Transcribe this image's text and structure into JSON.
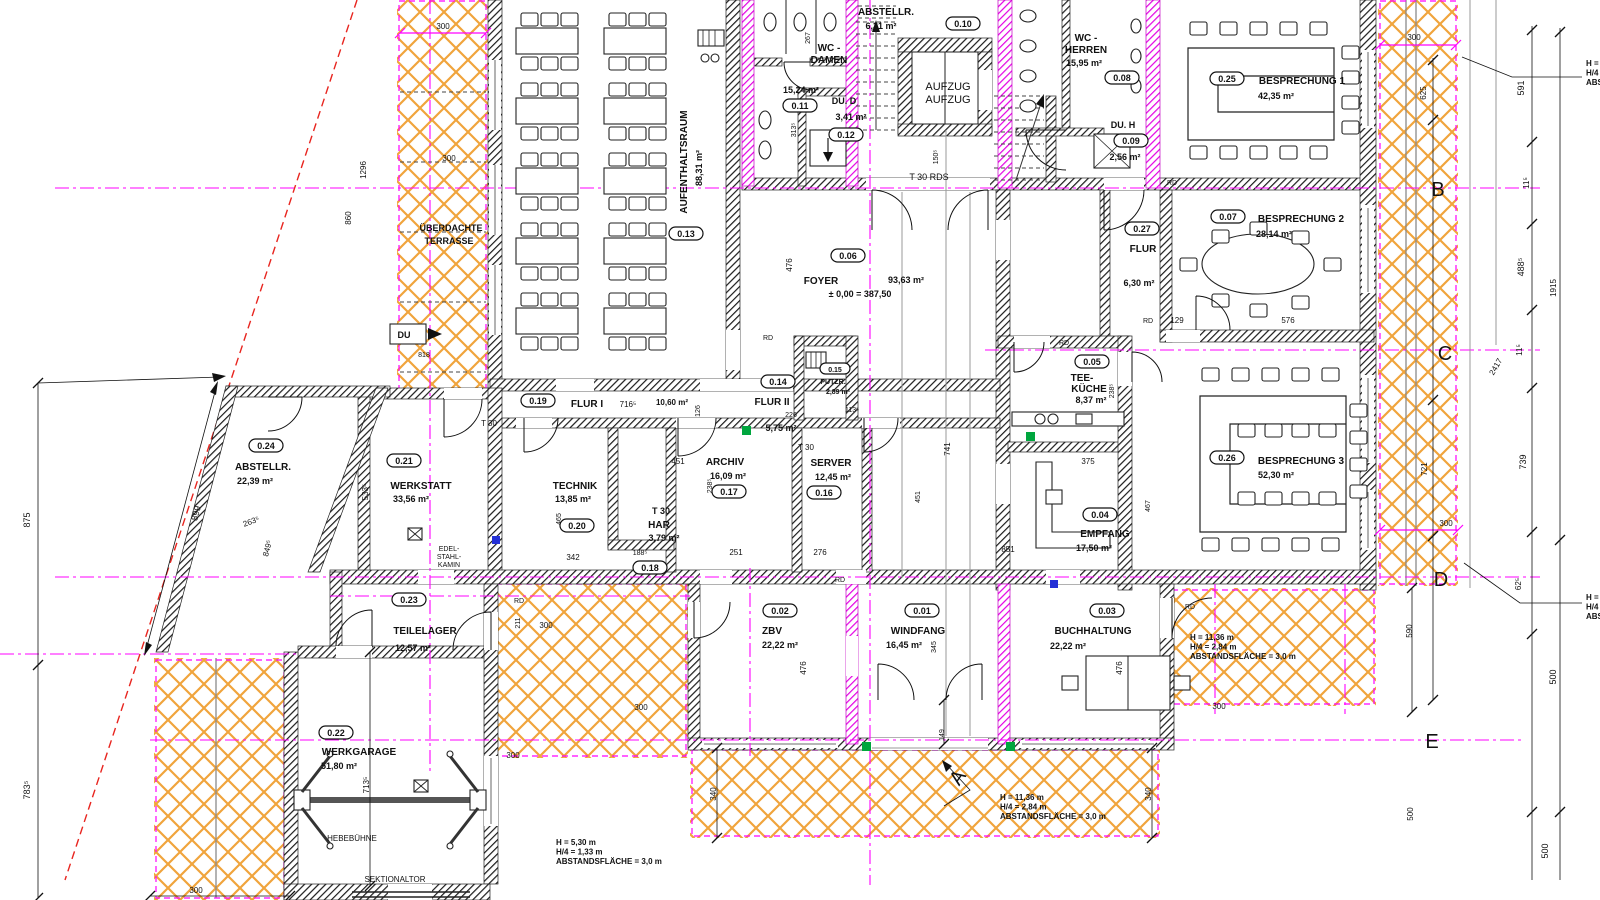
{
  "colors": {
    "hatch_orange": "#f0a43c",
    "axis_magenta": "#ff00ff",
    "boundary_red": "#e8251f",
    "wall_black": "#141414",
    "marker_green": "#00a63e",
    "marker_blue": "#2430d6"
  },
  "terrace": {
    "line1": "ÜBERDACHTE",
    "line2": "TERRASSE"
  },
  "rooms": [
    {
      "id": "0.01",
      "name": "WINDFANG",
      "area": "16,45 m²"
    },
    {
      "id": "0.02",
      "name": "ZBV",
      "area": "22,22 m²"
    },
    {
      "id": "0.03",
      "name": "BUCHHALTUNG",
      "area": "22,22 m²"
    },
    {
      "id": "0.04",
      "name": "EMPFANG",
      "area": "17,50 m²"
    },
    {
      "id": "0.05",
      "name": "TEE-",
      "name2": "KÜCHE",
      "area": "8,37 m²"
    },
    {
      "id": "0.06",
      "name": "FOYER",
      "area": "93,63 m²",
      "level": "± 0,00 = 387,50"
    },
    {
      "id": "0.07",
      "name": "BESPRECHUNG 2",
      "area": "28,14 m²"
    },
    {
      "id": "0.08",
      "name": "WC -",
      "name2": "HERREN",
      "area": "15,95 m²"
    },
    {
      "id": "0.09",
      "name": "DU. H",
      "area": "2,56 m²"
    },
    {
      "id": "0.10",
      "name": "ABSTELLR.",
      "area": "6,31 m²"
    },
    {
      "id": "0.11",
      "name": "WC -",
      "name2": "DAMEN",
      "area": "15,24 m²"
    },
    {
      "id": "0.12",
      "name": "DU. D",
      "area": "3,41 m²"
    },
    {
      "id": "0.13",
      "name": "AUFENTHALTSRAUM",
      "area": "88,31 m²"
    },
    {
      "id": "0.14",
      "name": "FLUR II",
      "area": "5,75 m²"
    },
    {
      "id": "0.15",
      "name": "PUTZR.",
      "area": "2,89 m²"
    },
    {
      "id": "0.16",
      "name": "SERVER",
      "area": "12,45 m²"
    },
    {
      "id": "0.17",
      "name": "ARCHIV",
      "area": "16,09 m²"
    },
    {
      "id": "0.18",
      "name": "HAR",
      "pre": "T 30",
      "area": "3,79 m²"
    },
    {
      "id": "0.19",
      "name": "FLUR I",
      "area": "10,60 m²"
    },
    {
      "id": "0.20",
      "name": "TECHNIK",
      "area": "13,85 m²"
    },
    {
      "id": "0.21",
      "name": "WERKSTATT",
      "area": "33,56 m²"
    },
    {
      "id": "0.22",
      "name": "WERKGARAGE",
      "area": "51,80 m²"
    },
    {
      "id": "0.23",
      "name": "TEILELAGER",
      "area": "12,57 m²"
    },
    {
      "id": "0.24",
      "name": "ABSTELLR.",
      "area": "22,39 m²"
    },
    {
      "id": "0.25",
      "name": "BESPRECHUNG 1",
      "area": "42,35 m²"
    },
    {
      "id": "0.26",
      "name": "BESPRECHUNG 3",
      "area": "52,30 m²"
    },
    {
      "id": "0.27",
      "name": "FLUR",
      "area": "6,30 m²"
    }
  ],
  "notes": [
    {
      "lines": [
        "H = 5,30 m",
        "H/4 = 1,33 m",
        "ABSTANDSFLÄCHE = 3,0 m"
      ],
      "x": 556,
      "y": 845
    },
    {
      "lines": [
        "H = 11,36 m",
        "H/4 = 2,84 m",
        "ABSTANDSFLÄCHE = 3,0 m"
      ],
      "x": 1000,
      "y": 800
    },
    {
      "lines": [
        "H = 11,36 m",
        "H/4 = 2,84 m",
        "ABSTANDSFLÄCHE = 3,0 m"
      ],
      "x": 1190,
      "y": 640
    },
    {
      "lines": [
        "H =",
        "H/4",
        "ABS"
      ],
      "x": 1586,
      "y": 66
    },
    {
      "lines": [
        "H =",
        "H/4",
        "ABS"
      ],
      "x": 1586,
      "y": 600
    }
  ],
  "grid_letters": [
    {
      "t": "A",
      "x": 963,
      "y": 781,
      "r": -55
    },
    {
      "t": "B",
      "x": 1438,
      "y": 196
    },
    {
      "t": "C",
      "x": 1445,
      "y": 360
    },
    {
      "t": "D",
      "x": 1441,
      "y": 586
    },
    {
      "t": "E",
      "x": 1432,
      "y": 748
    }
  ],
  "labels": [
    {
      "t": "AUFZUG",
      "x": 948,
      "y": 90,
      "s": 11
    },
    {
      "t": "AUFZUG",
      "x": 948,
      "y": 103,
      "s": 11
    },
    {
      "t": "T 30 RDS",
      "x": 929,
      "y": 180,
      "s": 9
    },
    {
      "t": "T 30",
      "x": 489,
      "y": 426
    },
    {
      "t": "T 30",
      "x": 806,
      "y": 450
    },
    {
      "t": "DU",
      "x": 404,
      "y": 338,
      "s": 9,
      "w": 700
    },
    {
      "t": "HEBEBÜHNE",
      "x": 352,
      "y": 841
    },
    {
      "t": "SEKTIONALTOR",
      "x": 395,
      "y": 882
    },
    {
      "t": "EDEL-",
      "x": 449,
      "y": 551,
      "s": 7
    },
    {
      "t": "STAHL-",
      "x": 449,
      "y": 559,
      "s": 7
    },
    {
      "t": "KAMIN",
      "x": 449,
      "y": 567,
      "s": 7
    },
    {
      "t": "RD",
      "x": 768,
      "y": 340,
      "s": 7
    },
    {
      "t": "RD",
      "x": 1064,
      "y": 345,
      "s": 7
    },
    {
      "t": "RD",
      "x": 1148,
      "y": 323,
      "s": 7
    },
    {
      "t": "RD",
      "x": 1172,
      "y": 185,
      "s": 7
    },
    {
      "t": "RD",
      "x": 840,
      "y": 582,
      "s": 7
    },
    {
      "t": "RD",
      "x": 1190,
      "y": 609,
      "s": 7
    },
    {
      "t": "RD",
      "x": 519,
      "y": 603,
      "s": 7
    },
    {
      "t": "226",
      "x": 791,
      "y": 417,
      "s": 7
    },
    {
      "t": "113⁵",
      "x": 852,
      "y": 412,
      "s": 7
    },
    {
      "t": "716⁵",
      "x": 628,
      "y": 407
    },
    {
      "t": "10,60 m²",
      "x": 672,
      "y": 405,
      "w": 600
    },
    {
      "t": "875",
      "x": 30,
      "y": 520,
      "r": -90,
      "s": 9
    },
    {
      "t": "783⁵",
      "x": 30,
      "y": 790,
      "r": -90,
      "s": 9
    },
    {
      "t": "899",
      "x": 199,
      "y": 514,
      "r": -75,
      "s": 9
    },
    {
      "t": "263⁵",
      "x": 252,
      "y": 524,
      "r": -20
    },
    {
      "t": "849⁵",
      "x": 270,
      "y": 549,
      "r": -75
    },
    {
      "t": "1296",
      "x": 366,
      "y": 170,
      "r": -90
    },
    {
      "t": "860",
      "x": 351,
      "y": 218,
      "r": -90
    },
    {
      "t": "300",
      "x": 443,
      "y": 29
    },
    {
      "t": "300",
      "x": 449,
      "y": 161,
      "c": "#666"
    },
    {
      "t": "818",
      "x": 424,
      "y": 357,
      "s": 7
    },
    {
      "t": "533⁵",
      "x": 368,
      "y": 492,
      "r": -90
    },
    {
      "t": "465",
      "x": 561,
      "y": 519,
      "r": -90,
      "s": 7
    },
    {
      "t": "126",
      "x": 700,
      "y": 411,
      "r": -90,
      "s": 7
    },
    {
      "t": "451",
      "x": 678,
      "y": 464
    },
    {
      "t": "238⁵",
      "x": 712,
      "y": 486,
      "r": -90,
      "s": 7
    },
    {
      "t": "188⁵",
      "x": 640,
      "y": 555,
      "s": 7
    },
    {
      "t": "342",
      "x": 573,
      "y": 560
    },
    {
      "t": "251",
      "x": 736,
      "y": 555
    },
    {
      "t": "276",
      "x": 820,
      "y": 555
    },
    {
      "t": "851",
      "x": 1008,
      "y": 552
    },
    {
      "t": "375",
      "x": 1088,
      "y": 464
    },
    {
      "t": "467",
      "x": 1150,
      "y": 506,
      "r": -90,
      "s": 7
    },
    {
      "t": "238⁵",
      "x": 1114,
      "y": 391,
      "r": -90,
      "s": 7
    },
    {
      "t": "129",
      "x": 1177,
      "y": 323
    },
    {
      "t": "576",
      "x": 1288,
      "y": 323
    },
    {
      "t": "150⁵",
      "x": 938,
      "y": 157,
      "r": -90,
      "s": 7
    },
    {
      "t": "741",
      "x": 950,
      "y": 449,
      "r": -90
    },
    {
      "t": "451",
      "x": 920,
      "y": 497,
      "r": -90,
      "s": 7
    },
    {
      "t": "476",
      "x": 806,
      "y": 668,
      "r": -90
    },
    {
      "t": "345",
      "x": 936,
      "y": 647,
      "r": -90,
      "s": 7
    },
    {
      "t": "149",
      "x": 944,
      "y": 735,
      "r": -90,
      "s": 7
    },
    {
      "t": "476",
      "x": 1122,
      "y": 668,
      "r": -90
    },
    {
      "t": "476",
      "x": 792,
      "y": 265,
      "r": -90
    },
    {
      "t": "211",
      "x": 520,
      "y": 623,
      "r": -90,
      "s": 7
    },
    {
      "t": "300",
      "x": 546,
      "y": 628
    },
    {
      "t": "300",
      "x": 641,
      "y": 710
    },
    {
      "t": "300",
      "x": 513,
      "y": 758
    },
    {
      "t": "300",
      "x": 196,
      "y": 893
    },
    {
      "t": "713⁵",
      "x": 369,
      "y": 785,
      "r": -90
    },
    {
      "t": "340",
      "x": 716,
      "y": 794,
      "r": -90
    },
    {
      "t": "340",
      "x": 1151,
      "y": 794,
      "r": -90
    },
    {
      "t": "300",
      "x": 1219,
      "y": 709
    },
    {
      "t": "591",
      "x": 1524,
      "y": 88,
      "r": -90,
      "s": 9
    },
    {
      "t": "11⁵",
      "x": 1529,
      "y": 183,
      "r": -90
    },
    {
      "t": "488⁵",
      "x": 1524,
      "y": 267,
      "r": -90,
      "s": 9
    },
    {
      "t": "1915",
      "x": 1556,
      "y": 288,
      "r": -90
    },
    {
      "t": "11⁵",
      "x": 1522,
      "y": 350,
      "r": -90
    },
    {
      "t": "739",
      "x": 1526,
      "y": 462,
      "r": -90,
      "s": 9
    },
    {
      "t": "62⁵",
      "x": 1521,
      "y": 584,
      "r": -90
    },
    {
      "t": "500",
      "x": 1556,
      "y": 677,
      "r": -90,
      "s": 9
    },
    {
      "t": "500",
      "x": 1548,
      "y": 851,
      "r": -90,
      "s": 9
    },
    {
      "t": "625",
      "x": 1426,
      "y": 93,
      "r": -90
    },
    {
      "t": "721",
      "x": 1427,
      "y": 469,
      "r": -90
    },
    {
      "t": "590",
      "x": 1412,
      "y": 631,
      "r": -90
    },
    {
      "t": "500",
      "x": 1413,
      "y": 814,
      "r": -90
    },
    {
      "t": "2417",
      "x": 1498,
      "y": 368,
      "r": -60
    },
    {
      "t": "300",
      "x": 1414,
      "y": 40
    },
    {
      "t": "300",
      "x": 1446,
      "y": 526
    },
    {
      "t": "313⁵",
      "x": 796,
      "y": 130,
      "r": -90,
      "s": 7
    },
    {
      "t": "267",
      "x": 810,
      "y": 38,
      "r": -90,
      "s": 7
    }
  ]
}
